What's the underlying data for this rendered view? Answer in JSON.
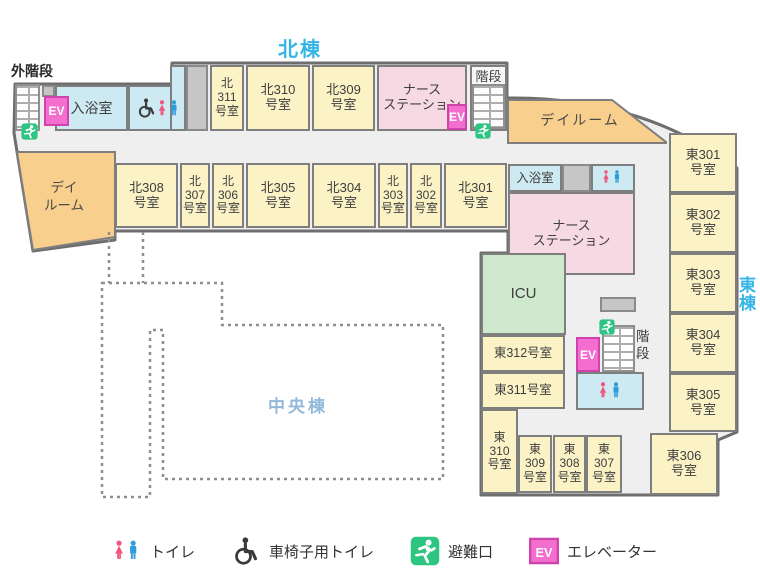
{
  "titles": {
    "north_wing": "北棟",
    "east_wing": "東\n棟",
    "central_wing": "中央棟",
    "outer_stairs": "外階段",
    "stairs_north": "階段",
    "stairs_east": "階\n段",
    "dayroom_west": "デイ\nルーム",
    "dayroom_east": "デイルーム"
  },
  "map": {
    "ev_label": "EV",
    "rooms": [
      {
        "name": "room-bath-west",
        "label": "入浴室",
        "type": "blue",
        "x": 55,
        "y": 85,
        "w": 73,
        "h": 46,
        "fs": 14
      },
      {
        "name": "room-wc-accessible-west",
        "label": "",
        "type": "blue",
        "x": 128,
        "y": 85,
        "w": 58,
        "h": 46
      },
      {
        "name": "connector-north",
        "label": "",
        "type": "blue",
        "x": 170,
        "y": 65,
        "w": 16,
        "h": 66
      },
      {
        "name": "gray-block-west",
        "label": "",
        "type": "gray",
        "x": 42,
        "y": 85,
        "w": 13,
        "h": 12
      },
      {
        "name": "gray-block-north",
        "label": "",
        "type": "gray",
        "x": 186,
        "y": 65,
        "w": 22,
        "h": 66
      },
      {
        "name": "room-n311",
        "label": "北\n311\n号室",
        "type": "yellow",
        "x": 210,
        "y": 65,
        "w": 34,
        "h": 66,
        "fs": 12
      },
      {
        "name": "room-n310",
        "label": "北310\n号室",
        "type": "yellow",
        "x": 246,
        "y": 65,
        "w": 64,
        "h": 66
      },
      {
        "name": "room-n309",
        "label": "北309\n号室",
        "type": "yellow",
        "x": 312,
        "y": 65,
        "w": 63,
        "h": 66
      },
      {
        "name": "nurse-station-north",
        "label": "ナース\nステーション",
        "type": "pink",
        "x": 377,
        "y": 65,
        "w": 90,
        "h": 66
      },
      {
        "name": "stairs-room-north",
        "label": "",
        "type": "white",
        "x": 470,
        "y": 65,
        "w": 37,
        "h": 66
      },
      {
        "name": "room-n308",
        "label": "北308\n号室",
        "type": "yellow",
        "x": 115,
        "y": 163,
        "w": 63,
        "h": 65
      },
      {
        "name": "room-n307",
        "label": "北\n307\n号室",
        "type": "yellow",
        "x": 180,
        "y": 163,
        "w": 30,
        "h": 65,
        "fs": 12
      },
      {
        "name": "room-n306",
        "label": "北\n306\n号室",
        "type": "yellow",
        "x": 212,
        "y": 163,
        "w": 32,
        "h": 65,
        "fs": 12
      },
      {
        "name": "room-n305",
        "label": "北305\n号室",
        "type": "yellow",
        "x": 246,
        "y": 163,
        "w": 64,
        "h": 65
      },
      {
        "name": "room-n304",
        "label": "北304\n号室",
        "type": "yellow",
        "x": 312,
        "y": 163,
        "w": 64,
        "h": 65
      },
      {
        "name": "room-n303",
        "label": "北\n303\n号室",
        "type": "yellow",
        "x": 378,
        "y": 163,
        "w": 30,
        "h": 65,
        "fs": 12
      },
      {
        "name": "room-n302",
        "label": "北\n302\n号室",
        "type": "yellow",
        "x": 410,
        "y": 163,
        "w": 32,
        "h": 65,
        "fs": 12
      },
      {
        "name": "room-n301",
        "label": "北301\n号室",
        "type": "yellow",
        "x": 444,
        "y": 163,
        "w": 63,
        "h": 65
      },
      {
        "name": "room-bath-east",
        "label": "入浴室",
        "type": "blue",
        "x": 508,
        "y": 164,
        "w": 54,
        "h": 28,
        "fs": 12.5
      },
      {
        "name": "gray-block-east-top",
        "label": "",
        "type": "gray",
        "x": 562,
        "y": 164,
        "w": 29,
        "h": 28
      },
      {
        "name": "room-toilet-east-top",
        "label": "",
        "type": "blue",
        "x": 591,
        "y": 164,
        "w": 44,
        "h": 28
      },
      {
        "name": "nurse-station-east",
        "label": "ナース\nステーション",
        "type": "pink",
        "x": 508,
        "y": 192,
        "w": 127,
        "h": 83
      },
      {
        "name": "room-icu",
        "label": "ICU",
        "type": "green",
        "x": 481,
        "y": 253,
        "w": 85,
        "h": 82,
        "fs": 15
      },
      {
        "name": "room-e312",
        "label": "東312号室",
        "type": "yellow",
        "x": 481,
        "y": 335,
        "w": 84,
        "h": 37,
        "fs": 12.5
      },
      {
        "name": "room-e311",
        "label": "東311号室",
        "type": "yellow",
        "x": 481,
        "y": 372,
        "w": 84,
        "h": 37,
        "fs": 12.5
      },
      {
        "name": "room-e310",
        "label": "東\n310\n号室",
        "type": "yellow",
        "x": 481,
        "y": 409,
        "w": 37,
        "h": 85,
        "fs": 12
      },
      {
        "name": "room-e309",
        "label": "東\n309\n号室",
        "type": "yellow",
        "x": 518,
        "y": 435,
        "w": 34,
        "h": 58,
        "fs": 12
      },
      {
        "name": "room-e308",
        "label": "東\n308\n号室",
        "type": "yellow",
        "x": 553,
        "y": 435,
        "w": 33,
        "h": 58,
        "fs": 12
      },
      {
        "name": "room-e307",
        "label": "東\n307\n号室",
        "type": "yellow",
        "x": 586,
        "y": 435,
        "w": 36,
        "h": 58,
        "fs": 12
      },
      {
        "name": "room-e306",
        "label": "東306\n号室",
        "type": "yellow",
        "x": 650,
        "y": 433,
        "w": 68,
        "h": 62
      },
      {
        "name": "room-e301",
        "label": "東301\n号室",
        "type": "yellow",
        "x": 669,
        "y": 133,
        "w": 68,
        "h": 60
      },
      {
        "name": "room-e302",
        "label": "東302\n号室",
        "type": "yellow",
        "x": 669,
        "y": 193,
        "w": 68,
        "h": 60
      },
      {
        "name": "room-e303",
        "label": "東303\n号室",
        "type": "yellow",
        "x": 669,
        "y": 253,
        "w": 68,
        "h": 60
      },
      {
        "name": "room-e304",
        "label": "東304\n号室",
        "type": "yellow",
        "x": 669,
        "y": 313,
        "w": 68,
        "h": 60
      },
      {
        "name": "room-e305",
        "label": "東305\n号室",
        "type": "yellow",
        "x": 669,
        "y": 373,
        "w": 68,
        "h": 59
      },
      {
        "name": "gray-block-east-mid",
        "label": "",
        "type": "gray",
        "x": 600,
        "y": 297,
        "w": 36,
        "h": 15
      },
      {
        "name": "room-toilet-east-bottom",
        "label": "",
        "type": "blue",
        "x": 576,
        "y": 372,
        "w": 68,
        "h": 38
      }
    ],
    "stairs": [
      {
        "name": "outer-stairs-west",
        "x": 15,
        "y": 84,
        "w": 25,
        "h": 47
      },
      {
        "name": "stairs-north",
        "x": 472,
        "y": 84,
        "w": 33,
        "h": 45
      },
      {
        "name": "stairs-east",
        "x": 602,
        "y": 325,
        "w": 33,
        "h": 47
      }
    ],
    "ev_boxes": [
      {
        "name": "elevator-west",
        "x": 44,
        "y": 96,
        "w": 25,
        "h": 30
      },
      {
        "name": "elevator-north",
        "x": 447,
        "y": 104,
        "w": 20,
        "h": 26
      },
      {
        "name": "elevator-east",
        "x": 576,
        "y": 337,
        "w": 24,
        "h": 35
      }
    ],
    "icons": [
      {
        "name": "wheelchair-icon",
        "x": 136,
        "y": 94,
        "w": 21,
        "h": 28
      },
      {
        "name": "female-icon",
        "x": 156,
        "y": 96,
        "w": 12,
        "h": 26
      },
      {
        "name": "male-icon",
        "x": 168,
        "y": 96,
        "w": 12,
        "h": 26
      },
      {
        "name": "female-icon",
        "x": 601,
        "y": 166,
        "w": 10,
        "h": 23
      },
      {
        "name": "male-icon",
        "x": 612,
        "y": 166,
        "w": 10,
        "h": 23
      },
      {
        "name": "female-icon",
        "x": 597,
        "y": 377,
        "w": 12,
        "h": 28
      },
      {
        "name": "male-icon",
        "x": 610,
        "y": 377,
        "w": 12,
        "h": 28
      },
      {
        "name": "exit-icon",
        "x": 21,
        "y": 123,
        "w": 17,
        "h": 17
      },
      {
        "name": "exit-icon",
        "x": 475,
        "y": 123,
        "w": 16,
        "h": 16
      },
      {
        "name": "exit-icon",
        "x": 599,
        "y": 319,
        "w": 16,
        "h": 16
      }
    ]
  },
  "legend": {
    "items": [
      {
        "icon": "toilet-pair-icon",
        "label": "トイレ"
      },
      {
        "icon": "wheelchair-icon",
        "label": "車椅子用トイレ"
      },
      {
        "icon": "exit-icon",
        "label": "避難口"
      },
      {
        "icon": "ev-icon",
        "label": "エレベーター"
      }
    ]
  },
  "palette": {
    "room_yellow": "#fbf2c6",
    "room_pink": "#f7d9e3",
    "room_blue": "#cde9f2",
    "room_green": "#cfe9cf",
    "dayroom_orange": "#f9cf8e",
    "ev_pink": "#f36ece",
    "exit_green": "#2ec482",
    "female_pink": "#f0537b",
    "male_blue": "#2f9cdc",
    "wing_title_blue": "#35b5e5",
    "central_blue": "#92b9da",
    "wall_gray": "#6e6e6e",
    "floor_gray": "#efefef"
  }
}
